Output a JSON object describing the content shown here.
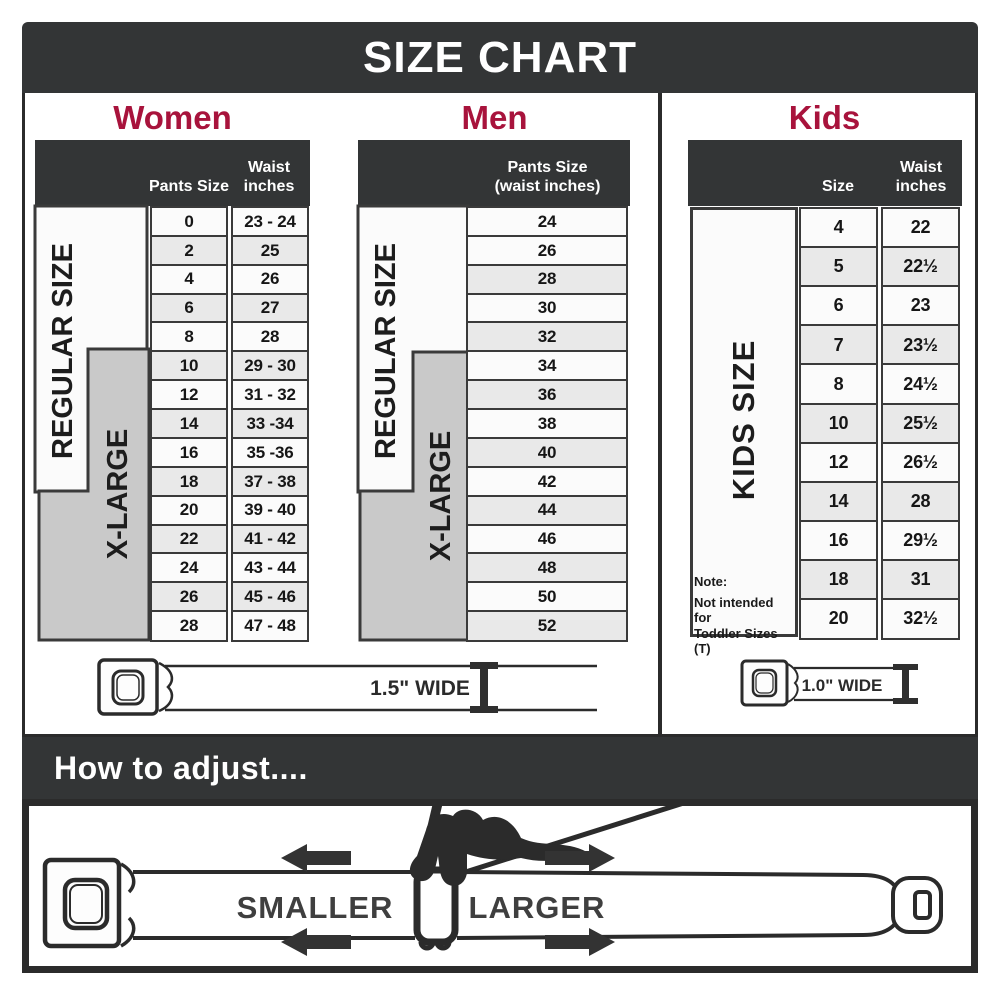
{
  "title": "SIZE CHART",
  "colors": {
    "banner": "#333536",
    "heading_accent": "#a8133c",
    "row_shade": "#e9e9e9",
    "band_gray": "#c9c9c9",
    "line_dark": "#2b2b2b"
  },
  "chart_data": [
    {
      "type": "table",
      "title": "Women",
      "side_bands": [
        "REGULAR SIZE",
        "X-LARGE"
      ],
      "columns": [
        "Pants Size",
        "Waist\ninches"
      ],
      "rows": [
        [
          "0",
          "23 - 24"
        ],
        [
          "2",
          "25"
        ],
        [
          "4",
          "26"
        ],
        [
          "6",
          "27"
        ],
        [
          "8",
          "28"
        ],
        [
          "10",
          "29 - 30"
        ],
        [
          "12",
          "31 - 32"
        ],
        [
          "14",
          "33 -34"
        ],
        [
          "16",
          "35 -36"
        ],
        [
          "18",
          "37 - 38"
        ],
        [
          "20",
          "39 - 40"
        ],
        [
          "22",
          "41 - 42"
        ],
        [
          "24",
          "43 - 44"
        ],
        [
          "26",
          "45 - 46"
        ],
        [
          "28",
          "47 - 48"
        ]
      ]
    },
    {
      "type": "table",
      "title": "Men",
      "side_bands": [
        "REGULAR SIZE",
        "X-LARGE"
      ],
      "columns": [
        "Pants Size\n(waist inches)"
      ],
      "rows": [
        [
          "24"
        ],
        [
          "26"
        ],
        [
          "28"
        ],
        [
          "30"
        ],
        [
          "32"
        ],
        [
          "34"
        ],
        [
          "36"
        ],
        [
          "38"
        ],
        [
          "40"
        ],
        [
          "42"
        ],
        [
          "44"
        ],
        [
          "46"
        ],
        [
          "48"
        ],
        [
          "50"
        ],
        [
          "52"
        ]
      ]
    },
    {
      "type": "table",
      "title": "Kids",
      "side_bands": [
        "KIDS SIZE"
      ],
      "columns": [
        "Size",
        "Waist\ninches"
      ],
      "rows": [
        [
          "4",
          "22"
        ],
        [
          "5",
          "22½"
        ],
        [
          "6",
          "23"
        ],
        [
          "7",
          "23½"
        ],
        [
          "8",
          "24½"
        ],
        [
          "10",
          "25½"
        ],
        [
          "12",
          "26½"
        ],
        [
          "14",
          "28"
        ],
        [
          "16",
          "29½"
        ],
        [
          "18",
          "31"
        ],
        [
          "20",
          "32½"
        ]
      ],
      "note": {
        "title": "Note:",
        "line1": "Not intended for",
        "line2": "Toddler Sizes (T)"
      }
    }
  ],
  "belts": {
    "adult_width_label": "1.5\" WIDE",
    "kids_width_label": "1.0\" WIDE"
  },
  "how_to_adjust": {
    "title": "How to adjust....",
    "smaller": "SMALLER",
    "larger": "LARGER"
  }
}
